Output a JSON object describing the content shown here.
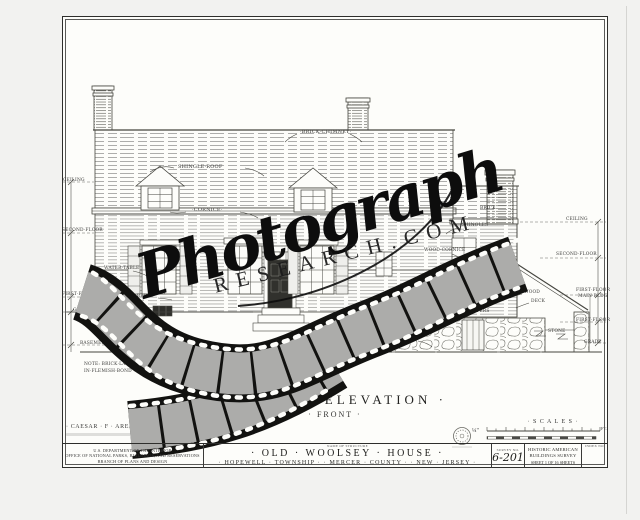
{
  "watermark": {
    "script": "Photograph",
    "domain": "RESEARCH.COM"
  },
  "titles": {
    "elevation": "· SOUTH · ELEVATION ·",
    "front": "· FRONT ·"
  },
  "credits": {
    "delineator": "· CAESAR · F · ARENA ·  · DEL ·"
  },
  "scale": {
    "label": "· S C A L E S ·",
    "ratio": "¼\"",
    "feet_unit": "FT."
  },
  "note": {
    "line1": "NOTE: BRICK·LAID",
    "line2": "IN·FLEMISH·BOND"
  },
  "labels": {
    "shingle_roof": "SHINGLE·ROOF",
    "brick_chimney": "·BRICK·CHIMNEY·",
    "cornice": "·CORNICE·",
    "ceiling_left": "CEILING",
    "second_floor_left": "SECOND·FLOOR",
    "first_floor_left": "FIRST·FLOOR",
    "grade_left": "GRADE",
    "basement": "BASEMENT",
    "water_table": "WATER·TABLE",
    "mould_brick": "MOULD·BRICK",
    "brick": "BRICK",
    "shingles": "·SHINGLES·",
    "wood_cornice": "WOOD·CORNICE",
    "ceiling_right": "CEILING",
    "second_floor_right": "SECOND·FLOOR",
    "first_floor_main_1": "FIRST·FLOOR",
    "first_floor_main_2": "MAIN·BLDG",
    "first_floor_right": "FIRST·FLOOR",
    "grade_right": "GRADE",
    "shutter": "SHUTTER",
    "area_louvers": "AREA·LOUVERS",
    "wood": "WOOD",
    "deck": "DECK",
    "stone": "STONE",
    "stone_retaining_wall": "STONE·RETAINING·WALL"
  },
  "titleblock": {
    "dept_line1": "U.S. DEPARTMENT OF THE INTERIOR",
    "dept_line2": "OFFICE OF NATIONAL PARKS, BUILDINGS, AND RESERVATIONS",
    "dept_line3": "BRANCH OF PLANS AND DESIGN",
    "name_header": "NAME OF STRUCTURE",
    "structure_name": "· OLD · WOOLSEY · HOUSE ·",
    "location": "· HOPEWELL · TOWNSHIP ·  · MERCER · COUNTY ·  · NEW · JERSEY ·",
    "survey_header": "SURVEY NO.",
    "survey_no": "6-201",
    "habs_line1": "HISTORIC AMERICAN",
    "habs_line2": "BUILDINGS SURVEY",
    "sheet_info": "SHEET 1 OF 16 SHEETS",
    "index_header": "INDEX NO."
  }
}
